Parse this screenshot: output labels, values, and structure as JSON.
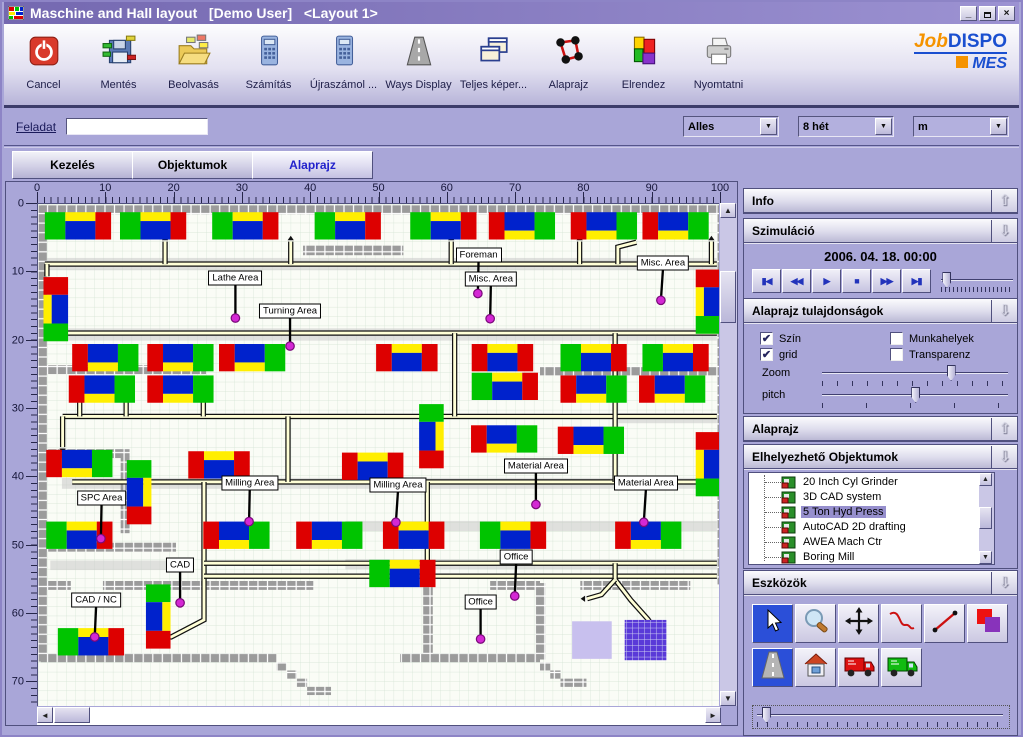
{
  "window": {
    "title": "Maschine and Hall layout   [Demo User]   <Layout 1>",
    "buttons": [
      "minimize",
      "restore",
      "close"
    ]
  },
  "toolbar": {
    "buttons": [
      {
        "label": "Cancel",
        "icon": "power"
      },
      {
        "label": "Mentés",
        "icon": "save"
      },
      {
        "label": "Beolvasás",
        "icon": "open"
      },
      {
        "label": "Számítás",
        "icon": "calculator"
      },
      {
        "label": "Újraszámol ...",
        "icon": "calculator"
      },
      {
        "label": "Ways Display",
        "icon": "road"
      },
      {
        "label": "Teljes képer...",
        "icon": "windows"
      },
      {
        "label": "Alaprajz",
        "icon": "graph"
      },
      {
        "label": "Elrendez",
        "icon": "blocks"
      },
      {
        "label": "Nyomtatni",
        "icon": "printer"
      }
    ],
    "logo": {
      "part1": "Job",
      "part2": "DISPO",
      "part3": "MES"
    }
  },
  "filter": {
    "feladat_label": "Feladat",
    "feladat_value": "",
    "dropdowns": [
      "Alles",
      "8 hét",
      "m"
    ]
  },
  "tabs": [
    {
      "label": "Kezelés",
      "active": false
    },
    {
      "label": "Objektumok",
      "active": false
    },
    {
      "label": "Alaprajz",
      "active": true
    }
  ],
  "canvas": {
    "h_ruler": [
      0,
      10,
      20,
      30,
      40,
      50,
      60,
      70,
      80,
      90,
      100
    ],
    "v_ruler": [
      0,
      10,
      20,
      30,
      40,
      50,
      60,
      70
    ],
    "machine_colors": {
      "G": "#00c400",
      "R": "#dd0000",
      "B": "#0022cc",
      "Y": "#ffee00"
    },
    "patterns": {
      "A": [
        [
          0,
          0,
          3,
          4,
          "G"
        ],
        [
          3,
          0,
          4.4,
          1.3,
          "Y"
        ],
        [
          3,
          1.3,
          4.4,
          2.7,
          "B"
        ],
        [
          7.4,
          0,
          2.3,
          4,
          "R"
        ]
      ],
      "B": [
        [
          0,
          0,
          2.3,
          4,
          "R"
        ],
        [
          2.3,
          0,
          4.4,
          2.7,
          "B"
        ],
        [
          2.3,
          2.7,
          4.4,
          1.3,
          "Y"
        ],
        [
          6.7,
          0,
          3,
          4,
          "G"
        ]
      ],
      "D": [
        [
          0,
          0,
          2.3,
          4,
          "R"
        ],
        [
          2.3,
          0,
          4.4,
          1.3,
          "Y"
        ],
        [
          2.3,
          1.3,
          4.4,
          2.7,
          "B"
        ],
        [
          6.7,
          0,
          2.3,
          4,
          "R"
        ]
      ],
      "VA": [
        [
          0,
          0,
          3.6,
          2.6,
          "R"
        ],
        [
          0,
          2.6,
          1.2,
          4.2,
          "Y"
        ],
        [
          1.2,
          2.6,
          2.4,
          4.2,
          "B"
        ],
        [
          0,
          6.8,
          3.6,
          2.6,
          "G"
        ]
      ],
      "VB": [
        [
          0,
          0,
          3.6,
          2.6,
          "G"
        ],
        [
          0,
          2.6,
          2.4,
          4.2,
          "B"
        ],
        [
          2.4,
          2.6,
          1.2,
          4.2,
          "Y"
        ],
        [
          0,
          6.8,
          3.6,
          2.6,
          "R"
        ]
      ]
    },
    "machines": [
      [
        1,
        1.2,
        "A"
      ],
      [
        12,
        1.2,
        "A"
      ],
      [
        25.5,
        1.2,
        "A"
      ],
      [
        40.5,
        1.2,
        "A"
      ],
      [
        54.5,
        1.2,
        "A"
      ],
      [
        66,
        1.2,
        "B"
      ],
      [
        78,
        1.2,
        "B"
      ],
      [
        88.5,
        1.2,
        "B"
      ],
      [
        5,
        20.5,
        "B"
      ],
      [
        16,
        20.5,
        "B"
      ],
      [
        26.5,
        20.5,
        "B"
      ],
      [
        49.5,
        20.5,
        "D"
      ],
      [
        63.5,
        20.5,
        "D"
      ],
      [
        76.5,
        20.5,
        "A"
      ],
      [
        88.5,
        20.5,
        "A"
      ],
      [
        4.5,
        25.1,
        "B"
      ],
      [
        16,
        25.1,
        "B"
      ],
      [
        63.5,
        24.7,
        "A"
      ],
      [
        76.5,
        25.1,
        "B"
      ],
      [
        88,
        25.1,
        "B"
      ],
      [
        1.2,
        36,
        "B"
      ],
      [
        22,
        36.2,
        "D"
      ],
      [
        44.5,
        36.4,
        "D"
      ],
      [
        63.4,
        32.4,
        "B"
      ],
      [
        76.1,
        32.6,
        "B"
      ],
      [
        1.2,
        46.5,
        "A"
      ],
      [
        24.2,
        46.5,
        "B"
      ],
      [
        37.8,
        46.5,
        "B"
      ],
      [
        50.5,
        46.5,
        "D"
      ],
      [
        64.7,
        46.5,
        "A"
      ],
      [
        84.5,
        46.5,
        "B"
      ],
      [
        48.5,
        52.1,
        "A"
      ],
      [
        2.9,
        62.1,
        "A"
      ],
      [
        0.8,
        10.7,
        "VA"
      ],
      [
        96.3,
        9.6,
        "VA"
      ],
      [
        96.3,
        33.4,
        "VA"
      ],
      [
        13,
        37.5,
        "VB"
      ],
      [
        55.8,
        29.3,
        "VB"
      ],
      [
        15.8,
        55.7,
        "VB"
      ]
    ],
    "walls": [
      [
        0.4,
        0.2,
        99.8,
        1.3
      ],
      [
        0,
        0.2,
        1.3,
        66.8
      ],
      [
        99.4,
        0.2,
        1.3,
        55.5
      ],
      [
        38.8,
        6.1,
        14.7,
        1.4
      ],
      [
        0.4,
        23.6,
        24.2,
        1.3
      ],
      [
        73.5,
        23.8,
        25.9,
        1.3
      ],
      [
        0.4,
        35.9,
        11.8,
        1.3
      ],
      [
        12.1,
        35.9,
        1.3,
        12.3
      ],
      [
        0.4,
        49.6,
        19.8,
        1.3
      ],
      [
        0.4,
        55.2,
        4.4,
        1.3
      ],
      [
        9.5,
        55.2,
        30.8,
        1.3
      ],
      [
        66.2,
        55.2,
        7.3,
        1.3
      ],
      [
        79.4,
        55.2,
        16.1,
        1.3
      ],
      [
        56.4,
        55.2,
        1.4,
        10.9
      ],
      [
        72.9,
        55.5,
        1.4,
        11.2
      ],
      [
        0.4,
        65.8,
        34.5,
        1.3
      ],
      [
        34.9,
        67.1,
        1.5,
        1.2
      ],
      [
        36.4,
        68.3,
        1.5,
        1.2
      ],
      [
        37.9,
        69.5,
        1.5,
        1.2
      ],
      [
        39.4,
        70.7,
        3.5,
        1.2
      ],
      [
        53,
        65.8,
        20.5,
        1.3
      ],
      [
        73.5,
        67.1,
        1.5,
        1.2
      ],
      [
        75,
        68.3,
        1.5,
        1.2
      ],
      [
        76.5,
        69.5,
        3.8,
        1.2
      ]
    ],
    "aisles": [
      [
        0.4,
        7.9,
        99,
        1.8
      ],
      [
        0.4,
        18.2,
        99,
        1.8
      ],
      [
        3.5,
        40.1,
        96,
        1.6
      ],
      [
        45,
        46.4,
        54.5,
        1.5
      ],
      [
        1.8,
        52.2,
        18.4,
        1.4
      ],
      [
        45,
        52,
        54.5,
        1.5
      ],
      [
        85,
        30.6,
        14.4,
        1.5
      ]
    ],
    "roads": [
      [
        [
          1,
          8.8
        ],
        [
          99.4,
          8.8
        ]
      ],
      [
        [
          1.3,
          18.9
        ],
        [
          99.4,
          18.9
        ]
      ],
      [
        [
          3.6,
          31.1
        ],
        [
          99.4,
          31.1
        ]
      ],
      [
        [
          5,
          40.7
        ],
        [
          99.4,
          40.7
        ]
      ],
      [
        [
          24.3,
          40.7
        ],
        [
          24.3,
          60.9
        ],
        [
          19.5,
          63.4
        ],
        [
          17.2,
          63.4
        ]
      ],
      [
        [
          24.3,
          52.6
        ],
        [
          99.4,
          52.6
        ]
      ],
      [
        [
          24.3,
          54.5
        ],
        [
          99.4,
          54.5
        ]
      ],
      [
        [
          57,
          40.7
        ],
        [
          57,
          54.5
        ]
      ],
      [
        [
          61,
          18.9
        ],
        [
          61,
          31.1
        ]
      ],
      [
        [
          84.5,
          18.9
        ],
        [
          84.5,
          40.7
        ]
      ],
      [
        [
          36.6,
          31.1
        ],
        [
          36.6,
          40.7
        ]
      ],
      [
        [
          1.3,
          8.8
        ],
        [
          1.3,
          10.6
        ]
      ],
      [
        [
          18.6,
          8.8
        ],
        [
          18.6,
          5.5
        ]
      ],
      [
        [
          37,
          8.8
        ],
        [
          37,
          5.5
        ]
      ],
      [
        [
          60.5,
          8.8
        ],
        [
          60.5,
          5.5
        ]
      ],
      [
        [
          79.3,
          8.8
        ],
        [
          79.3,
          5.5
        ]
      ],
      [
        [
          84.9,
          8.8
        ],
        [
          84.9,
          6.3
        ],
        [
          87.6,
          5.6
        ]
      ],
      [
        [
          98.6,
          8.8
        ],
        [
          98.6,
          5.5
        ]
      ],
      [
        [
          84.5,
          52.6
        ],
        [
          84.5,
          55
        ],
        [
          86.8,
          58
        ],
        [
          89.3,
          60.8
        ],
        [
          90.3,
          62.3
        ]
      ],
      [
        [
          84.5,
          55
        ],
        [
          82.5,
          57.2
        ],
        [
          80.4,
          57.8
        ]
      ],
      [
        [
          6.1,
          31.1
        ],
        [
          6.1,
          26.6
        ]
      ],
      [
        [
          12.9,
          31.1
        ],
        [
          12.9,
          26.6
        ]
      ],
      [
        [
          24.2,
          31.1
        ],
        [
          24.2,
          26.6
        ]
      ],
      [
        [
          3.6,
          31.1
        ],
        [
          3.6,
          35.6
        ]
      ]
    ],
    "arrows": [
      [
        1.3,
        10.8,
        "d"
      ],
      [
        18.6,
        5.3,
        "u"
      ],
      [
        37,
        5.3,
        "u"
      ],
      [
        60.5,
        5.3,
        "u"
      ],
      [
        79.3,
        5.3,
        "u"
      ],
      [
        98.6,
        5.3,
        "u"
      ],
      [
        17,
        63.4,
        "l"
      ],
      [
        80.1,
        57.8,
        "l"
      ],
      [
        6.1,
        26.4,
        "u"
      ],
      [
        12.9,
        26.4,
        "u"
      ],
      [
        24.2,
        26.4,
        "u"
      ],
      [
        3.6,
        35.8,
        "d"
      ]
    ],
    "zones": [
      {
        "x": 78.2,
        "y": 61.1,
        "w": 5.8,
        "h": 5.5,
        "kind": "plain"
      },
      {
        "x": 85.9,
        "y": 60.9,
        "w": 6.1,
        "h": 5.9,
        "kind": "grid"
      }
    ],
    "labels": [
      {
        "text": "Lathe Area",
        "x": 28.9,
        "y": 10.9,
        "dx": 28.9,
        "dy": 16.7
      },
      {
        "text": "Turning Area",
        "x": 36.9,
        "y": 15.6,
        "dx": 36.9,
        "dy": 20.8
      },
      {
        "text": "Foreman",
        "x": 64.5,
        "y": 7.4,
        "dx": 64.4,
        "dy": 13.1
      },
      {
        "text": "Misc. Area",
        "x": 66.3,
        "y": 11.0,
        "dx": 66.2,
        "dy": 16.8
      },
      {
        "text": "Misc. Area",
        "x": 91.5,
        "y": 8.6,
        "dx": 91.2,
        "dy": 14.1
      },
      {
        "text": "SPC Area",
        "x": 9.3,
        "y": 43.1,
        "dx": 9.2,
        "dy": 49.0
      },
      {
        "text": "Milling Area",
        "x": 31.0,
        "y": 40.8,
        "dx": 30.9,
        "dy": 46.5
      },
      {
        "text": "Milling Area",
        "x": 52.7,
        "y": 41.1,
        "dx": 52.4,
        "dy": 46.6
      },
      {
        "text": "Material Area",
        "x": 72.9,
        "y": 38.4,
        "dx": 72.9,
        "dy": 44.0
      },
      {
        "text": "Material Area",
        "x": 89.0,
        "y": 40.9,
        "dx": 88.7,
        "dy": 46.6
      },
      {
        "text": "CAD",
        "x": 20.8,
        "y": 52.9,
        "dx": 20.8,
        "dy": 58.4
      },
      {
        "text": "CAD / NC",
        "x": 8.5,
        "y": 58.0,
        "dx": 8.3,
        "dy": 63.4
      },
      {
        "text": "Office",
        "x": 70.0,
        "y": 51.7,
        "dx": 69.8,
        "dy": 57.4
      },
      {
        "text": "Office",
        "x": 64.8,
        "y": 58.3,
        "dx": 64.8,
        "dy": 63.7
      }
    ]
  },
  "panels": {
    "info": {
      "title": "Info",
      "arrow": "up"
    },
    "szimulacio": {
      "title": "Szimuláció",
      "arrow": "down",
      "date": "2006. 04. 18. 00:00",
      "buttons": [
        "skip-start",
        "rewind",
        "play",
        "stop",
        "fast-forward",
        "skip-end"
      ],
      "slider_value": 2
    },
    "tulajdonsagok": {
      "title": "Alaprajz tulajdonságok",
      "arrow": "down",
      "checkboxes": [
        {
          "label": "Szín",
          "checked": true
        },
        {
          "label": "grid",
          "checked": true
        },
        {
          "label": "Munkahelyek",
          "checked": false
        },
        {
          "label": "Transparenz",
          "checked": false
        }
      ],
      "sliders": [
        {
          "label": "Zoom",
          "value": 67
        },
        {
          "label": "pitch",
          "value": 48
        }
      ]
    },
    "alaprajz": {
      "title": "Alaprajz",
      "arrow": "up"
    },
    "objektumok": {
      "title": "Elhelyezhető Objektumok",
      "arrow": "down",
      "items": [
        {
          "label": "20 Inch Cyl Grinder",
          "selected": false
        },
        {
          "label": "3D CAD system",
          "selected": false
        },
        {
          "label": "5 Ton Hyd Press",
          "selected": true
        },
        {
          "label": "AutoCAD 2D drafting",
          "selected": false
        },
        {
          "label": "AWEA Mach Ctr",
          "selected": false
        },
        {
          "label": "Boring Mill",
          "selected": false
        }
      ]
    },
    "eszkozok": {
      "title": "Eszközök",
      "arrow": "down",
      "tools_row1": [
        {
          "name": "select",
          "selected": true
        },
        {
          "name": "zoom",
          "selected": false
        },
        {
          "name": "move",
          "selected": false
        },
        {
          "name": "curve",
          "selected": false
        },
        {
          "name": "line",
          "selected": false
        },
        {
          "name": "overlap",
          "selected": false
        }
      ],
      "tools_row2": [
        {
          "name": "road",
          "selected": true
        },
        {
          "name": "house",
          "selected": false
        },
        {
          "name": "truck-red",
          "selected": false
        },
        {
          "name": "truck-green",
          "selected": false
        }
      ],
      "slider_value": 2
    }
  }
}
